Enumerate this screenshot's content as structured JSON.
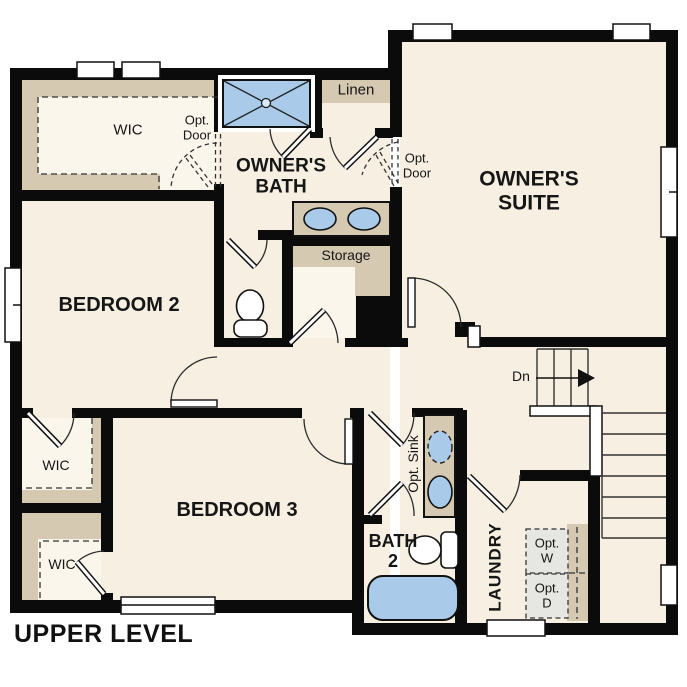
{
  "plan_title": "UPPER LEVEL",
  "colors": {
    "wall": "#0b0b0b",
    "floor": "#f6efe2",
    "closet_floor": "#fbf6ec",
    "shelving_tan": "#d5c9b2",
    "fixture_blue": "#a9cae8",
    "appliance_gray": "#e6e7e3",
    "text": "#161616"
  },
  "labels": {
    "wic_top_left": "WIC",
    "wic_middle": "WIC",
    "wic_bottom": "WIC",
    "opt_door_left": {
      "line1": "Opt.",
      "line2": "Door"
    },
    "opt_door_right": {
      "line1": "Opt.",
      "line2": "Door"
    },
    "owners_bath": {
      "line1": "OWNER'S",
      "line2": "BATH"
    },
    "owners_suite": {
      "line1": "OWNER'S",
      "line2": "SUITE"
    },
    "linen": "Linen",
    "storage": "Storage",
    "bedroom2": "BEDROOM 2",
    "bedroom3": "BEDROOM 3",
    "stairs_down": "Dn",
    "opt_sink": "Opt. Sink",
    "bath2": {
      "line1": "BATH",
      "line2": "2"
    },
    "laundry": "LAUNDRY",
    "opt_washer": {
      "line1": "Opt.",
      "line2": "W"
    },
    "opt_dryer": {
      "line1": "Opt.",
      "line2": "D"
    }
  },
  "fixtures": [
    "shower",
    "owners-bath-double-vanity",
    "water-closet-toilet",
    "chase",
    "bath2-vanity-optional-sink",
    "bath2-toilet",
    "bathtub",
    "optional-washer",
    "optional-dryer",
    "stairs-down"
  ]
}
